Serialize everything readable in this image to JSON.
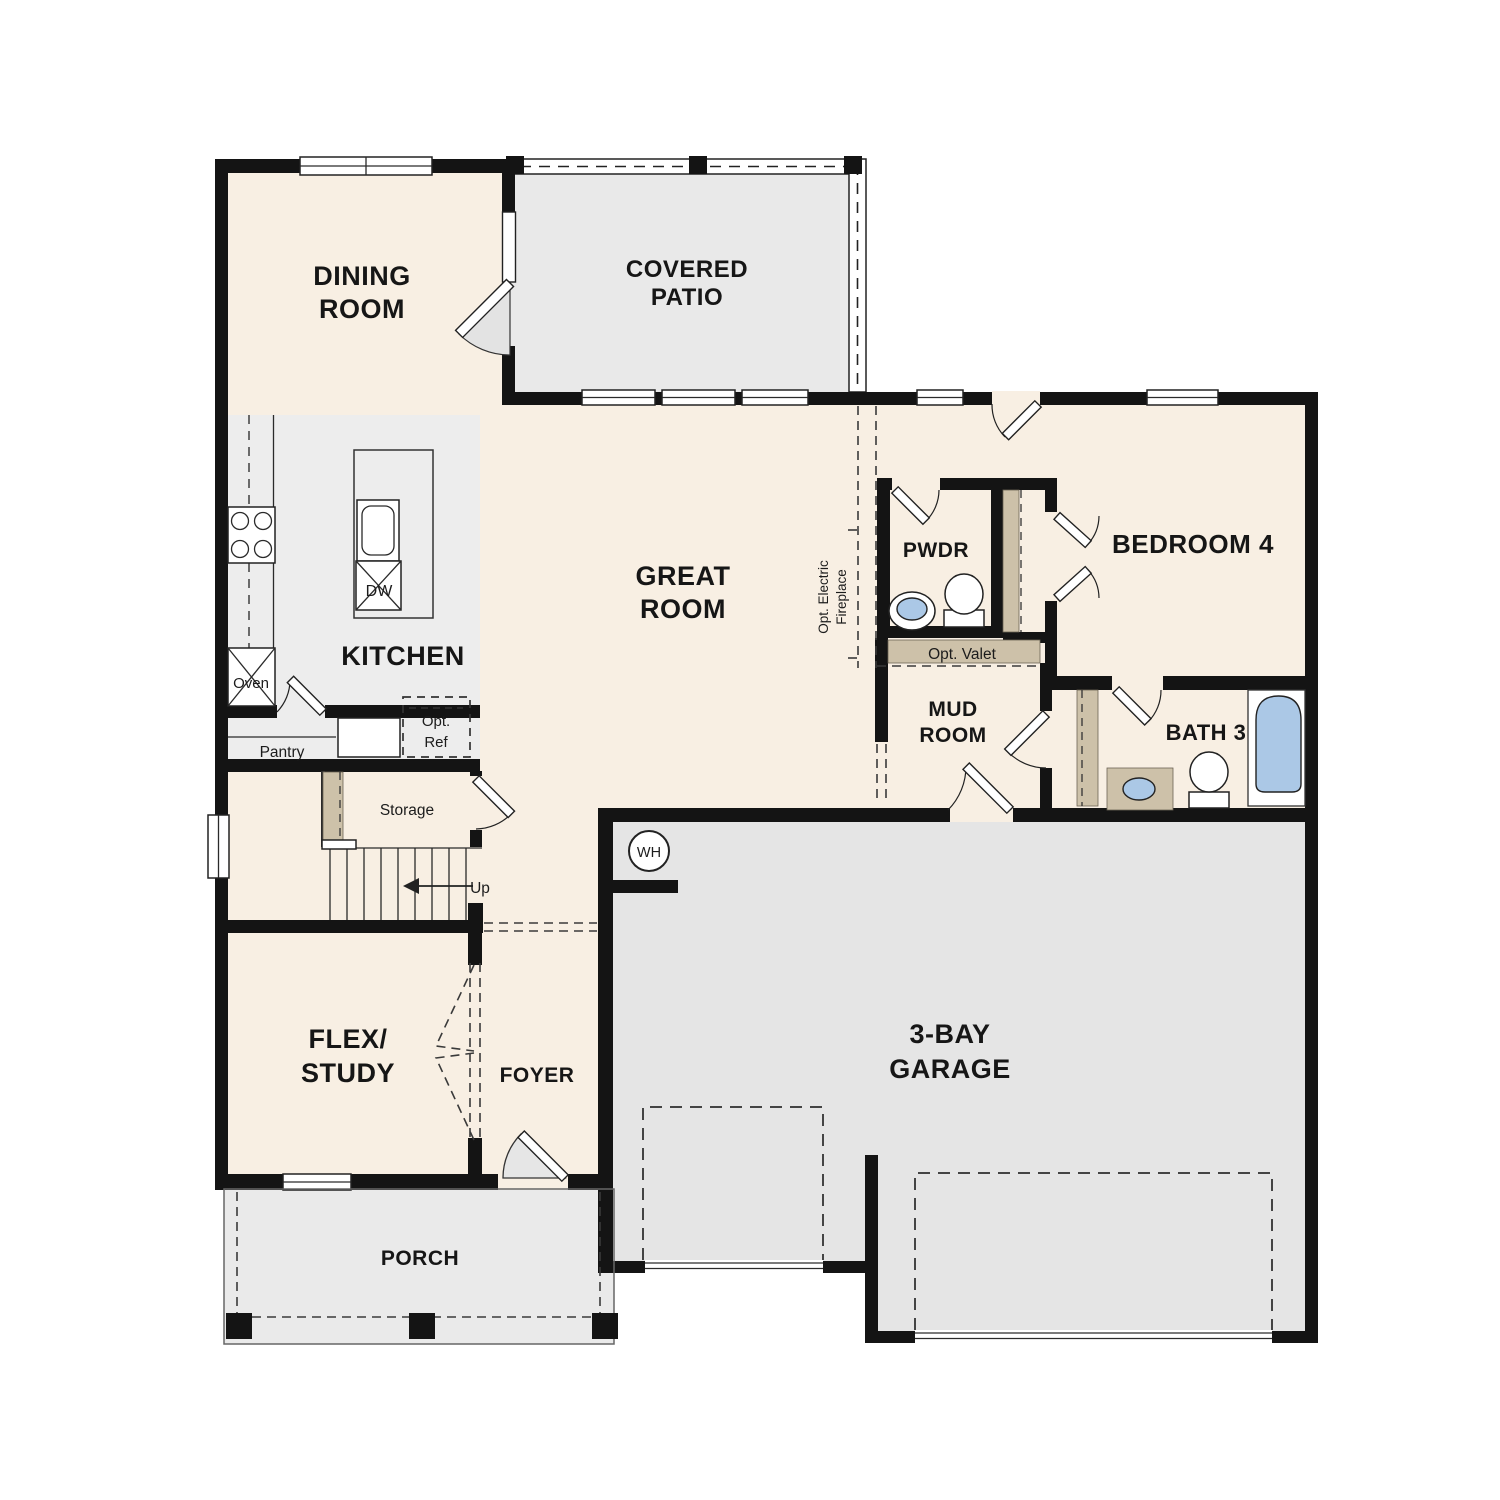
{
  "plan_title": "First floor plan",
  "colors": {
    "wall": "#141414",
    "floor_cream": "#f8efe3",
    "patio_gray": "#e9e9e9",
    "garage_gray": "#e5e5e5",
    "kitchen_gray": "#ededed",
    "porch_gray": "#eaeaea",
    "cabinet_tan": "#cdc1a9",
    "fixture_blue": "#abc8e6"
  },
  "rooms": {
    "dining": {
      "line1": "DINING",
      "line2": "ROOM"
    },
    "covered_patio": {
      "line1": "COVERED",
      "line2": "PATIO"
    },
    "kitchen": {
      "label": "KITCHEN"
    },
    "great_room": {
      "line1": "GREAT",
      "line2": "ROOM"
    },
    "powder": {
      "label": "PWDR"
    },
    "bedroom4": {
      "label": "BEDROOM 4"
    },
    "bath3": {
      "label": "BATH 3"
    },
    "mud_room": {
      "line1": "MUD",
      "line2": "ROOM"
    },
    "flex_study": {
      "line1": "FLEX/",
      "line2": "STUDY"
    },
    "foyer": {
      "label": "FOYER"
    },
    "porch": {
      "label": "PORCH"
    },
    "garage": {
      "line1": "3-BAY",
      "line2": "GARAGE"
    }
  },
  "features": {
    "oven": "Oven",
    "dishwasher": "DW",
    "pantry": "Pantry",
    "opt_ref_line1": "Opt.",
    "opt_ref_line2": "Ref",
    "storage": "Storage",
    "stairs_up": "Up",
    "water_heater": "WH",
    "opt_valet": "Opt. Valet",
    "opt_fireplace_line1": "Opt. Electric",
    "opt_fireplace_line2": "Fireplace"
  }
}
